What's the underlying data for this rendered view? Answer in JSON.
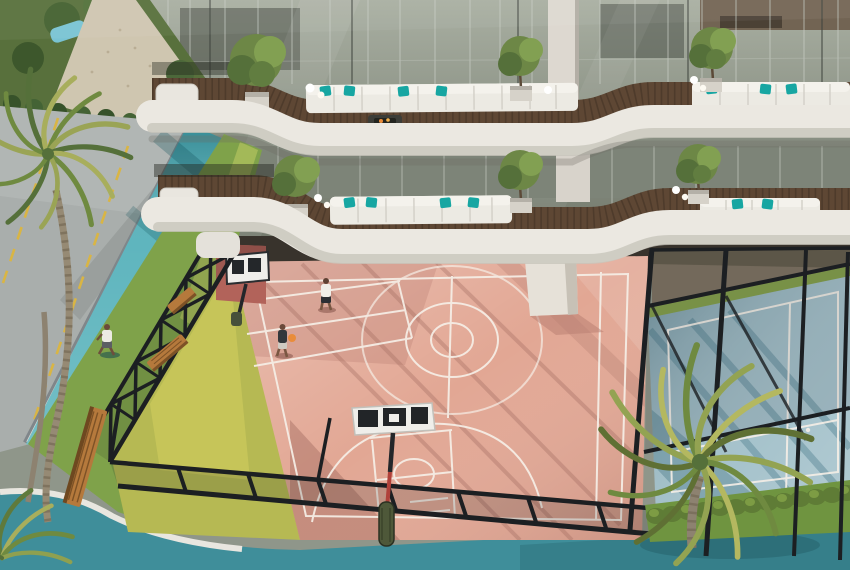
{
  "meta": {
    "type": "architectural-aerial-render",
    "subject": "residential building with balconies above sports courts"
  },
  "colors": {
    "balcony_white": "#ebe8e1",
    "deck_wood": "#5e4734",
    "sofa_white": "#eceae3",
    "cushion_teal": "#17a6a2",
    "glass_facade": "#8f968a",
    "court_pink": "#e2a794",
    "court_line": "#f6efe7",
    "track_teal": "#49abb5",
    "walkway_teal": "#3f8e9a",
    "padel_blue": "#9cbcc6",
    "grass_green": "#7fa24a",
    "lawn_yellow": "#b6b953",
    "road_gray": "#a9aeac",
    "road_line_yellow": "#d9b544",
    "fence_black": "#1c1f22",
    "palm_green": "#8a9a4e",
    "hedge_green": "#5f7c36",
    "bench_wood": "#b5793c",
    "fire_orange": "#e98c3a",
    "wall_white": "#dcdad4",
    "pool_blue": "#79c3d3",
    "pillar_white": "#e6e1d8",
    "backboard_white": "#efeeea"
  },
  "objects": {
    "building": {
      "floors_visible": 2,
      "balcony_style": "curved white wrap-around bands with wood decks",
      "furniture": "white modular sofas with teal cushions and fire tables",
      "balcony_trees": 6
    },
    "sports": {
      "main_court": "basketball court",
      "main_court_color": "pink",
      "secondary_court": "padel court",
      "secondary_court_color": "blue",
      "players_on_court": 2,
      "basketball_hoops": 2,
      "fence": "black lattice enclosure"
    },
    "people": {
      "total": 3,
      "jogger_on_track": 1,
      "basketball_players": 2
    },
    "landscape": {
      "palm_trees": 3,
      "benches": 3,
      "jogging_track": "teal",
      "road_marking": "yellow dashed lines",
      "hedge_row": 1,
      "pool_glimpse": 1
    }
  }
}
